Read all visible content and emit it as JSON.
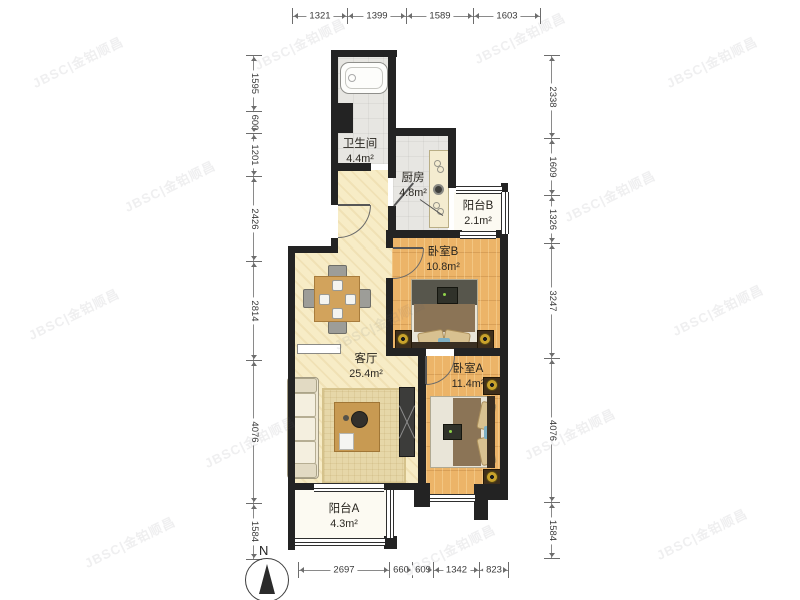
{
  "watermark": {
    "text": "JBSC|金铂顺昌"
  },
  "compass": {
    "label": "N"
  },
  "dimensions": {
    "top": [
      "1321",
      "1399",
      "1589",
      "1603"
    ],
    "left": [
      "1595",
      "600",
      "1201",
      "2426",
      "2814",
      "4076",
      "1584"
    ],
    "right": [
      "2338",
      "1609",
      "1326",
      "3247",
      "4076",
      "1584"
    ],
    "bottom": [
      "2697",
      "660",
      "609",
      "1342",
      "823"
    ]
  },
  "rooms": {
    "bathroom": {
      "name": "卫生间",
      "area": "4.4m²"
    },
    "kitchen": {
      "name": "厨房",
      "area": "4.8m²"
    },
    "balcony_b": {
      "name": "阳台B",
      "area": "2.1m²"
    },
    "bedroom_b": {
      "name": "卧室B",
      "area": "10.8m²"
    },
    "living": {
      "name": "客厅",
      "area": "25.4m²"
    },
    "bedroom_a": {
      "name": "卧室A",
      "area": "11.4m²"
    },
    "balcony_a": {
      "name": "阳台A",
      "area": "4.3m²"
    }
  },
  "colors": {
    "wall": "#232323",
    "floor_wood": "#ecb468",
    "floor_cream": "#f7ecc6",
    "floor_tile": "#e7e6e2",
    "floor_balcony": "#fcfaf2",
    "dim_text": "#3a3a3a"
  }
}
